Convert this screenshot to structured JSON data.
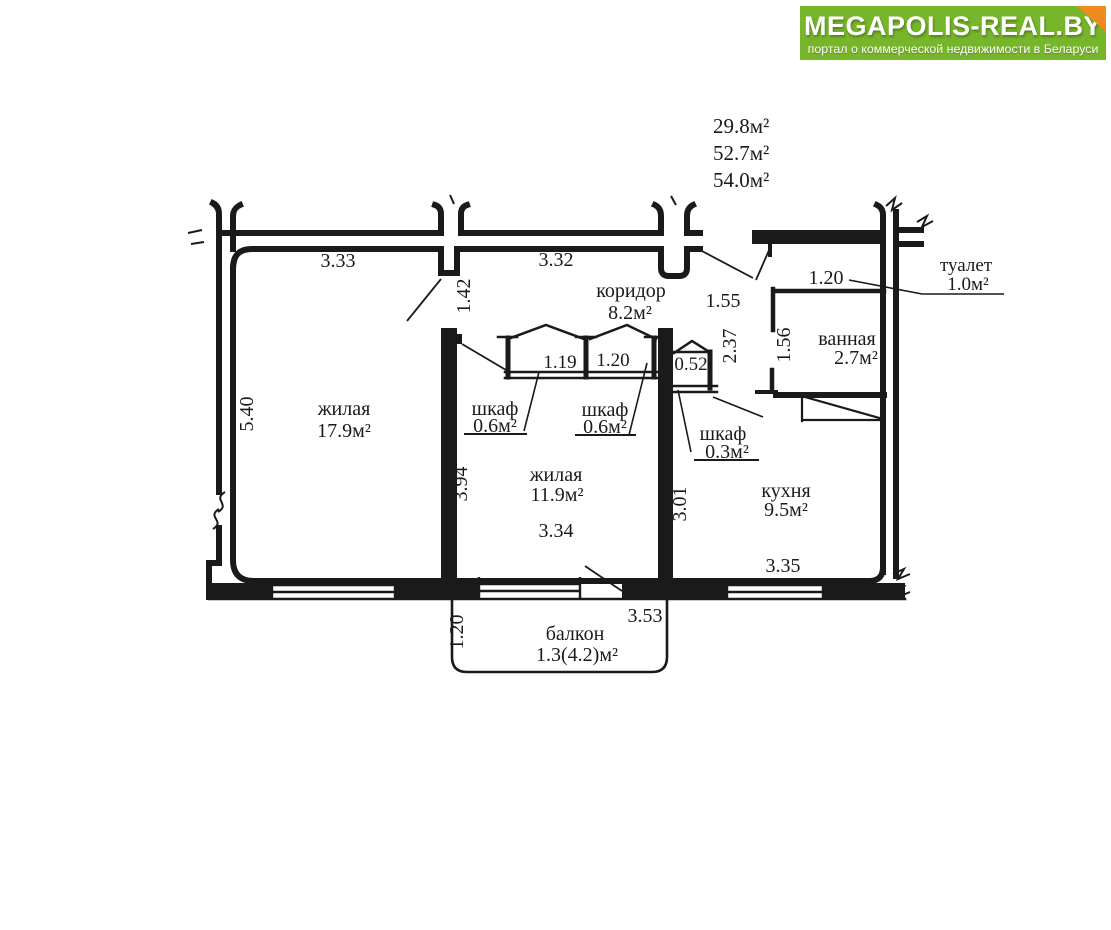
{
  "logo": {
    "title": "MEGAPOLIS-REAL.BY",
    "subtitle": "портал о коммерческой недвижимости в Беларуси",
    "bg_color": "#77b52b",
    "fold_color": "#ef8a1e"
  },
  "area_summary": {
    "line1": "29.8м²",
    "line2": "52.7м²",
    "line3": "54.0м²"
  },
  "rooms": {
    "living1": {
      "label": "жилая",
      "area": "17.9м²"
    },
    "living2": {
      "label": "жилая",
      "area": "11.9м²"
    },
    "kitchen": {
      "label": "кухня",
      "area": "9.5м²"
    },
    "corridor": {
      "label": "коридор",
      "area": "8.2м²"
    },
    "bathroom": {
      "label": "ванная",
      "area": "2.7м²"
    },
    "toilet": {
      "label": "туалет",
      "area": "1.0м²"
    },
    "closet_left": {
      "label": "шкаф",
      "area": "0.6м²"
    },
    "closet_mid": {
      "label": "шкаф",
      "area": "0.6м²"
    },
    "closet_small": {
      "label": "шкаф",
      "area": "0.3м²"
    },
    "balcony": {
      "label": "балкон",
      "area": "1.3(4.2)м²"
    }
  },
  "dimensions": {
    "living1_width": "3.33",
    "corridor_width": "3.32",
    "living1_height": "5.40",
    "living1_door": "1.42",
    "closet_left_width": "1.19",
    "closet_mid_width": "1.20",
    "closet_small_width": "0.52",
    "entry_width": "1.55",
    "toilet_width": "1.20",
    "hall_depth": "2.37",
    "bathroom_depth": "1.56",
    "living2_height": "3.94",
    "living2_width": "3.34",
    "kitchen_height": "3.01",
    "kitchen_width": "3.35",
    "balcony_width": "3.53",
    "balcony_depth": "1.20"
  }
}
